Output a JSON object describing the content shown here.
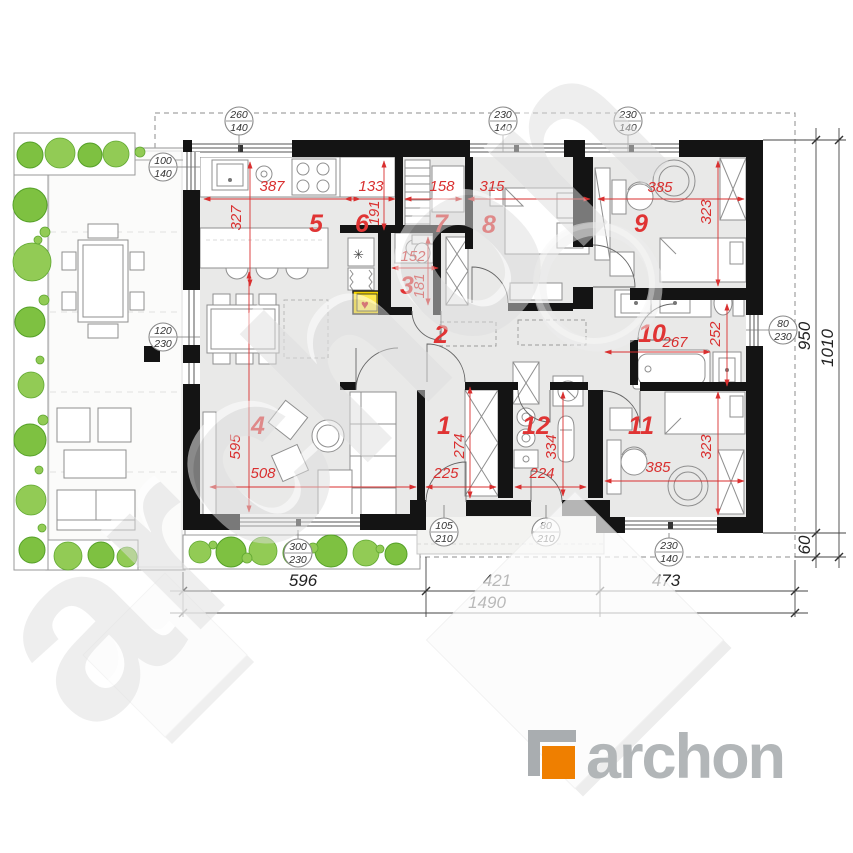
{
  "watermark": {
    "text": "archon"
  },
  "logo": {
    "brand": "archon",
    "orange": "#ef7f00",
    "gray": "#aeb2b4"
  },
  "rooms": [
    "1",
    "2",
    "3",
    "4",
    "5",
    "6",
    "7",
    "8",
    "9",
    "10",
    "11",
    "12"
  ],
  "red_dims": [
    "387",
    "133",
    "158",
    "315",
    "385",
    "327",
    "191",
    "323",
    "152",
    "181",
    "267",
    "252",
    "595",
    "508",
    "274",
    "225",
    "334",
    "224",
    "385",
    "323"
  ],
  "circles": [
    {
      "a": "260",
      "b": "140"
    },
    {
      "a": "230",
      "b": "140"
    },
    {
      "a": "230",
      "b": "140"
    },
    {
      "a": "100",
      "b": "140"
    },
    {
      "a": "120",
      "b": "230"
    },
    {
      "a": "80",
      "b": "230"
    },
    {
      "a": "105",
      "b": "210"
    },
    {
      "a": "80",
      "b": "210"
    },
    {
      "a": "300",
      "b": "230"
    },
    {
      "a": "230",
      "b": "140"
    }
  ],
  "dims_bottom": [
    "596",
    "421",
    "473",
    "1490"
  ],
  "dims_right": [
    "950",
    "60",
    "1010"
  ],
  "symbols": {
    "hob": "**",
    "vent": "✳",
    "heart": "♥"
  },
  "colors": {
    "dim_red": "#d92f2f",
    "wall_black": "#141414",
    "plant_green": "#7ec141",
    "floor_gray": "#e9e9e8",
    "watermark_gray": "#e0e0e0"
  }
}
